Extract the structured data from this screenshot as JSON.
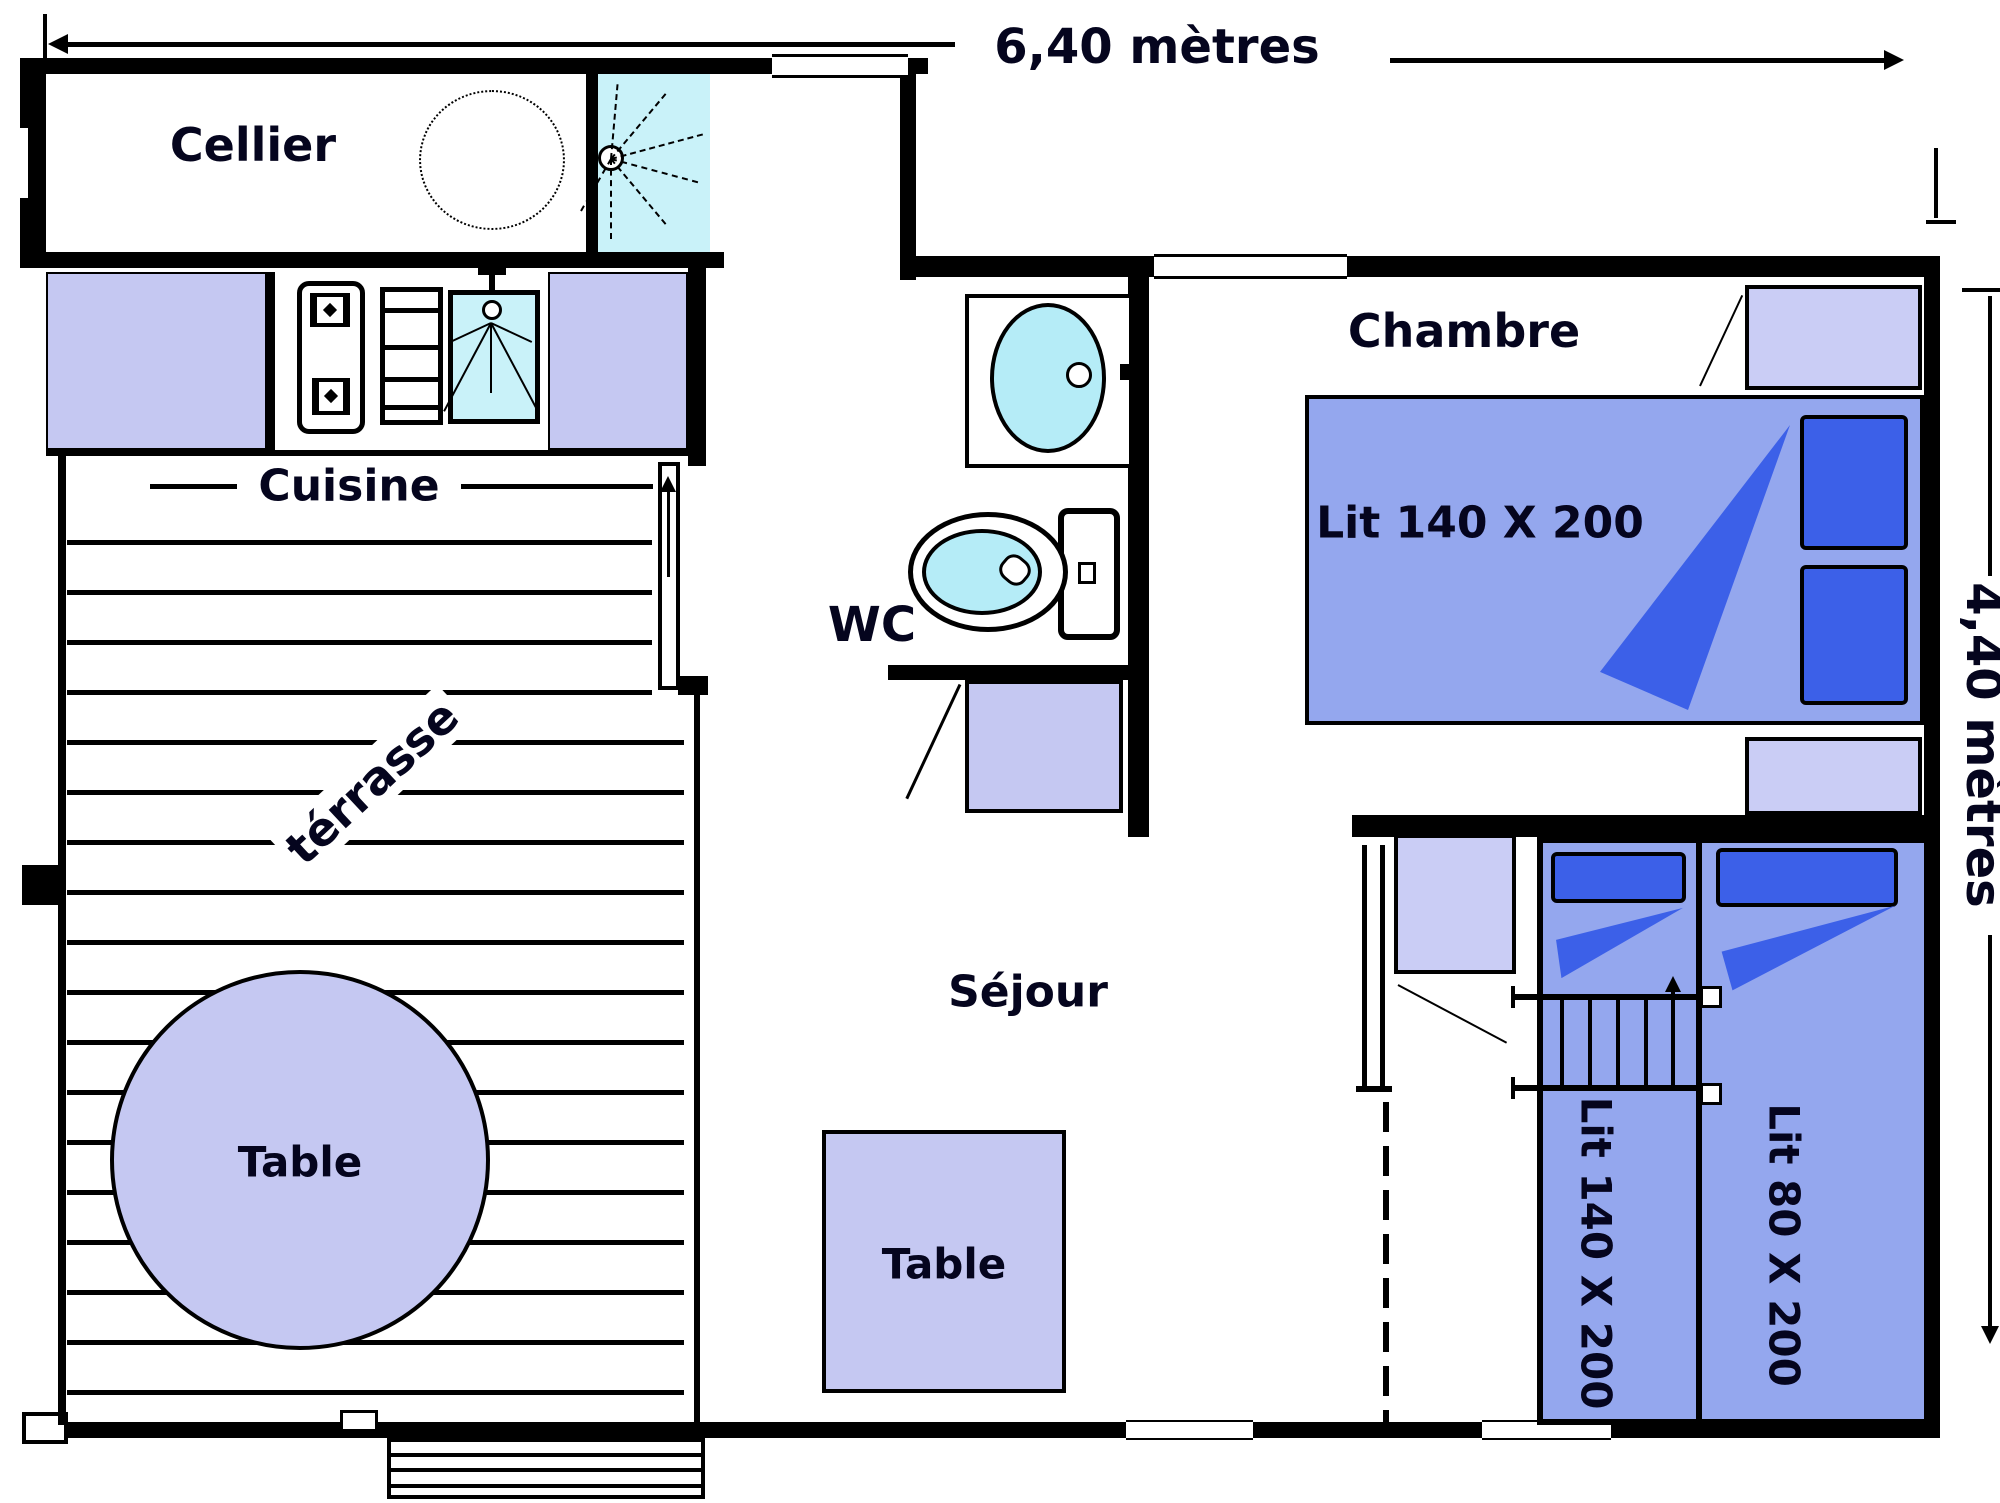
{
  "dimensions": {
    "width_label": "6,40 mètres",
    "height_label": "4,40 mètres"
  },
  "rooms": {
    "cellier": "Cellier",
    "cuisine": "Cuisine",
    "terrasse": "térrasse",
    "wc": "WC",
    "sejour": "Séjour",
    "chambre": "Chambre"
  },
  "furniture": {
    "terrasse_table": "Table",
    "sejour_table": "Table",
    "double_bed": "Lit 140 X 200",
    "bunk_bed": "Lit 140 X 200",
    "single_bed": "Lit 80 X 200"
  },
  "icons": {
    "shower-icon": "cyan square with dashed spray rays",
    "boiler-icon": "dotted circle",
    "stove-icon": "two burner squares with diamond dots",
    "shelf-icon": "rectangle with shelf lines",
    "sink-icon": "cyan box with drain circle and spray lines",
    "faucet-icon": "black T",
    "washbasin-icon": "cyan oval in cabinet",
    "toilet-icon": "cyan bowl with tank",
    "ladder-icon": "two rails with rungs and up arrow",
    "door-leaf-icon": "white rectangle with up arrow",
    "stairs-icon": "stepped rectangle"
  },
  "colors": {
    "background": "#ffffff",
    "wall": "#000000",
    "lavender": "#c5c8f2",
    "lavender_light": "#cacdf5",
    "periwinkle": "#94a7ee",
    "royal": "#3c60e8",
    "cyan_pale": "#c9f2f9",
    "cyan": "#b5ecf7"
  }
}
